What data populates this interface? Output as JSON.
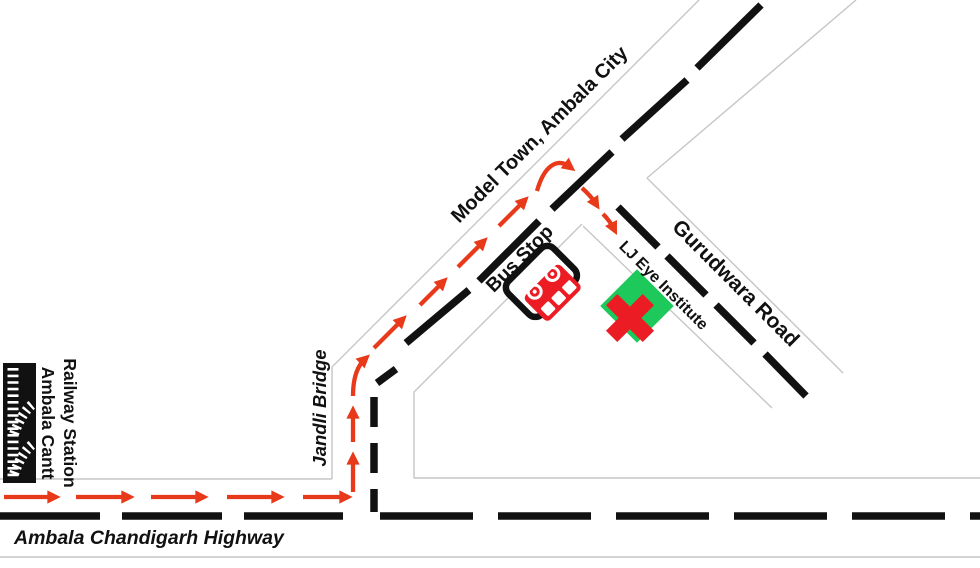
{
  "labels": {
    "railway_station_line1": "Ambala Cantt",
    "railway_station_line2": "Railway Station",
    "highway": "Ambala Chandigarh Highway",
    "jandli_bridge": "Jandli Bridge",
    "model_town": "Model Town, Ambala City",
    "bus_stop": "Bus Stop",
    "gurudwara_road": "Gurudwara Road",
    "destination": "LJ Eye Institute"
  },
  "colors": {
    "route_arrow": "#e8391b",
    "landmark_red": "#ec1c24",
    "destination_green": "#1cc95a",
    "road_dash": "#111111",
    "road_edge": "#c6c6c6"
  },
  "route": {
    "from": "Ambala Cantt Railway Station",
    "to": "LJ Eye Institute"
  }
}
